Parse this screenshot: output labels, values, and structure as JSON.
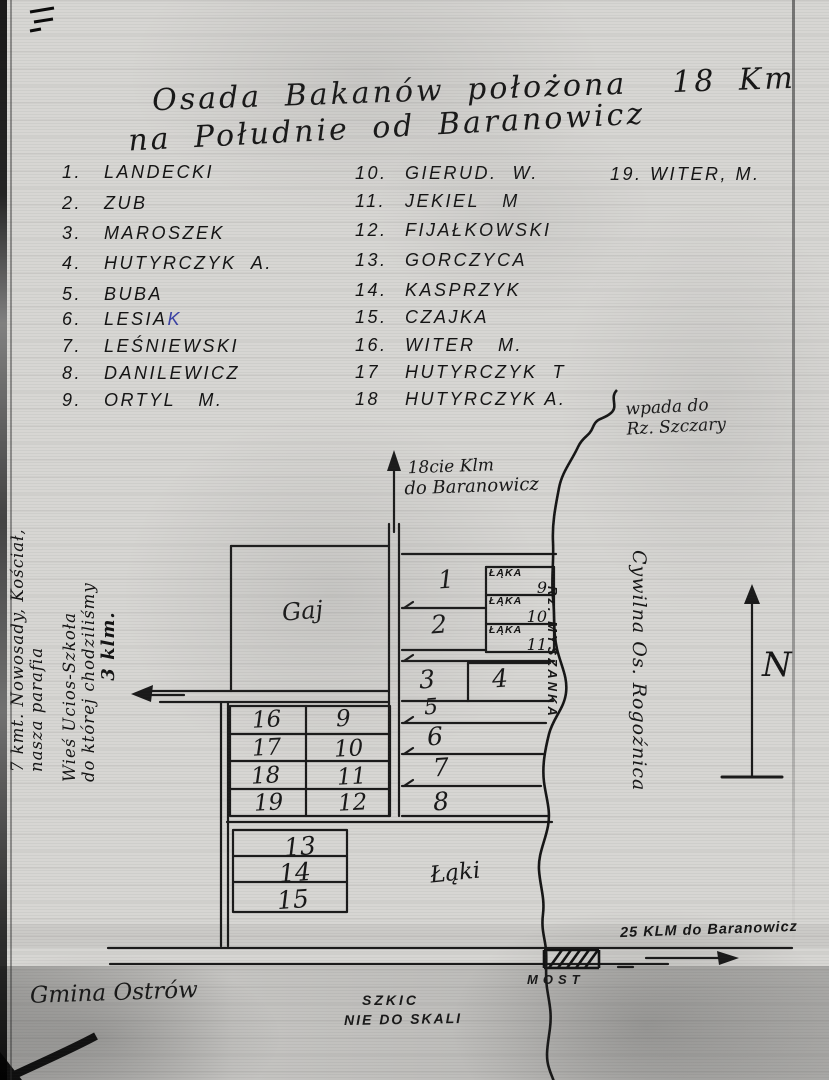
{
  "title": {
    "line1": "Osada Bakanów położona  18 Km",
    "line2": "na Południe od Baranowicz"
  },
  "residents": {
    "col1": [
      {
        "num": "1.",
        "name": "LANDECKI"
      },
      {
        "num": "2.",
        "name": "ZUB"
      },
      {
        "num": "3.",
        "name": "MAROSZEK"
      },
      {
        "num": "4.",
        "name": "HUTYRCZYK  A."
      },
      {
        "num": "5.",
        "name": "BUBA"
      },
      {
        "num": "6.",
        "name": "LESIA",
        "blue": "K"
      },
      {
        "num": "7.",
        "name": "LEŚNIEWSKI"
      },
      {
        "num": "8.",
        "name": "DANILEWICZ"
      },
      {
        "num": "9.",
        "name": "ORTYL   M."
      }
    ],
    "col2": [
      {
        "num": "10.",
        "name": "GIERUD.  W."
      },
      {
        "num": "11.",
        "name": "JEKIEL   M"
      },
      {
        "num": "12.",
        "name": "FIJAŁKOWSKI"
      },
      {
        "num": "13.",
        "name": "GORCZYCA"
      },
      {
        "num": "14.",
        "name": "KASPRZYK"
      },
      {
        "num": "15.",
        "name": "CZAJKA"
      },
      {
        "num": "16.",
        "name": "WITER   M."
      },
      {
        "num": "17",
        "name": "HUTYRCZYK  T"
      },
      {
        "num": "18",
        "name": "HUTYRCZYK A."
      }
    ],
    "col3": [
      {
        "num": "19.",
        "name": "WITER, M."
      }
    ]
  },
  "map": {
    "river_note": {
      "line1": "wpada do",
      "line2": "Rz. Szczary"
    },
    "north_road": {
      "line1": "18cie Klm",
      "line2": "do Baranowicz"
    },
    "river_label": "Rz. MYSZANKA",
    "east_settlement": "Cywilna Os. Rogoźnica",
    "compass": "N",
    "gaj": "Gaj",
    "laki": "Łąki",
    "meadows": [
      {
        "label": "ŁĄKA",
        "num": "9"
      },
      {
        "label": "ŁĄKA",
        "num": "10"
      },
      {
        "label": "ŁĄKA",
        "num": "11"
      }
    ],
    "east_plots": [
      "1",
      "2",
      "3",
      "4",
      "5",
      "6",
      "7",
      "8"
    ],
    "west_grid": [
      "16",
      "9",
      "17",
      "10",
      "18",
      "11",
      "19",
      "12"
    ],
    "south_plots": [
      "13",
      "14",
      "15"
    ],
    "south_road": "25 KLM do Baranowicz",
    "bridge": "MOST",
    "gmina": "Gmina Ostrów",
    "scale_note": {
      "line1": "SZKIC",
      "line2": "NIE DO SKALI"
    },
    "west_note1": {
      "line1": "7 kmt. Nowosady, Kościał,",
      "line2": "nasza parafia"
    },
    "west_note2": {
      "line1": "Wieś Ucios-Szkoła",
      "line2": "do której chodziliśmy",
      "line3": "3 klm."
    }
  },
  "colors": {
    "ink": "#1a1a1a",
    "blue_ink": "#3a41a6",
    "paper": "#d7d6d3"
  }
}
